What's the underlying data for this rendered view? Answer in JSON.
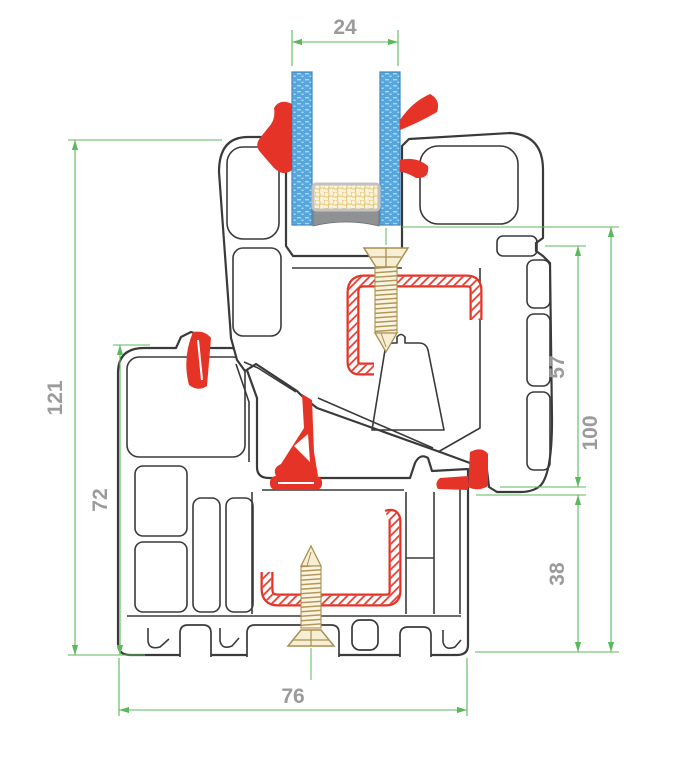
{
  "dims": {
    "glazing_width": "24",
    "overall_height": "121",
    "frame_height": "72",
    "sash_face_height": "57",
    "right_height": "100",
    "frame_overlap": "38",
    "profile_depth": "76"
  },
  "colors": {
    "dimension_line": "#5CB85C",
    "dimension_text": "#9B9B9B",
    "profile_outline": "#3A3A3A",
    "gasket_red": "#E63327",
    "steel_hatch_red": "#E63327",
    "glass_blue": "#57A7DE",
    "spacer_cream": "#FBF3D9",
    "sealant_gray": "#909192",
    "screw_tan": "#B2965A"
  },
  "components": [
    "frame-profile",
    "sash-profile",
    "glazing-bead",
    "glass-pane-left",
    "glass-pane-right",
    "spacer-bar",
    "edge-sealant",
    "glazing-gasket-left",
    "glazing-gasket-right",
    "outer-seal-gasket",
    "center-seal-gasket",
    "right-step-gasket",
    "steel-reinforcement-sash",
    "steel-reinforcement-frame",
    "fixing-screw-top",
    "fixing-screw-bottom"
  ]
}
